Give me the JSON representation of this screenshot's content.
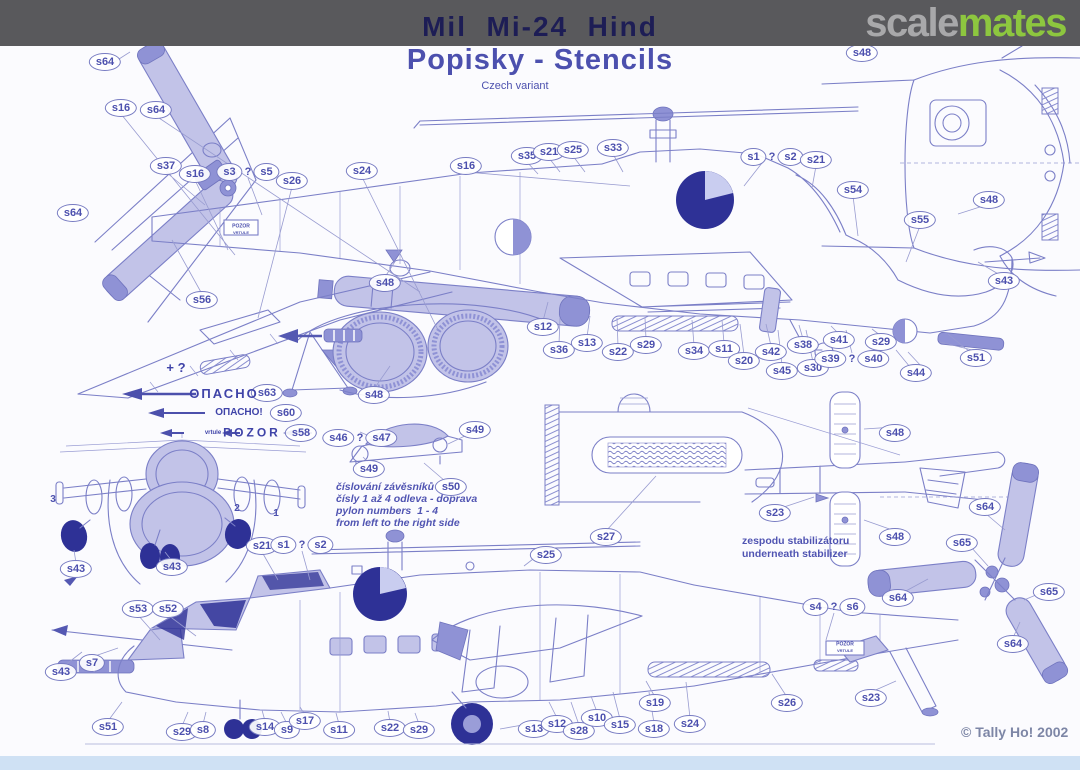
{
  "header": {
    "title": "Mil  Mi-24  Hind",
    "subtitle": "Popisky - Stencils",
    "variant": "Czech variant",
    "logo": {
      "part_gray": "scale",
      "part_green": "mates"
    }
  },
  "footer": {
    "copyright": "© Tally Ho! 2002"
  },
  "colors": {
    "bar": "#59595c",
    "title": "#1d1d55",
    "subtitle": "#4c50ae",
    "logo_gray": "#a8a8aa",
    "logo_green": "#8dc63f",
    "drawing_line": "#7b7fc7",
    "drawing_fill_light": "#c2c3e8",
    "drawing_fill_dark": "#2e3196",
    "footer_band": "#cfe1f4"
  },
  "callouts": [
    {
      "t": "s64",
      "x": 105,
      "y": 62
    },
    {
      "t": "s16",
      "x": 121,
      "y": 108
    },
    {
      "t": "s64",
      "x": 156,
      "y": 110
    },
    {
      "t": "s37",
      "x": 166,
      "y": 166
    },
    {
      "t": "s16",
      "x": 195,
      "y": 174
    },
    {
      "t": "s3 ? s5",
      "x": 248,
      "y": 172
    },
    {
      "t": "s64",
      "x": 73,
      "y": 213
    },
    {
      "t": "s26",
      "x": 292,
      "y": 181
    },
    {
      "t": "s24",
      "x": 362,
      "y": 171
    },
    {
      "t": "s16",
      "x": 466,
      "y": 166
    },
    {
      "t": "s48",
      "x": 385,
      "y": 283
    },
    {
      "t": "s35",
      "x": 527,
      "y": 156
    },
    {
      "t": "s21",
      "x": 549,
      "y": 152
    },
    {
      "t": "s25",
      "x": 573,
      "y": 150
    },
    {
      "t": "s33",
      "x": 613,
      "y": 148
    },
    {
      "t": "s1 ? s2",
      "x": 772,
      "y": 157
    },
    {
      "t": "s21",
      "x": 816,
      "y": 160
    },
    {
      "t": "s48",
      "x": 862,
      "y": 53
    },
    {
      "t": "s54",
      "x": 853,
      "y": 190
    },
    {
      "t": "s55",
      "x": 920,
      "y": 220
    },
    {
      "t": "s48",
      "x": 989,
      "y": 200
    },
    {
      "t": "s43",
      "x": 1004,
      "y": 281
    },
    {
      "t": "s51",
      "x": 976,
      "y": 358
    },
    {
      "t": "s44",
      "x": 916,
      "y": 373
    },
    {
      "t": "s12",
      "x": 543,
      "y": 327
    },
    {
      "t": "s36",
      "x": 559,
      "y": 350
    },
    {
      "t": "s13",
      "x": 587,
      "y": 343
    },
    {
      "t": "s22",
      "x": 618,
      "y": 352
    },
    {
      "t": "s29",
      "x": 646,
      "y": 345
    },
    {
      "t": "s34",
      "x": 694,
      "y": 351
    },
    {
      "t": "s11",
      "x": 724,
      "y": 349
    },
    {
      "t": "s20",
      "x": 744,
      "y": 361
    },
    {
      "t": "s42",
      "x": 771,
      "y": 352
    },
    {
      "t": "s45",
      "x": 782,
      "y": 371
    },
    {
      "t": "s38",
      "x": 803,
      "y": 345
    },
    {
      "t": "s30",
      "x": 813,
      "y": 368
    },
    {
      "t": "s41",
      "x": 839,
      "y": 340
    },
    {
      "t": "s39 ? s40",
      "x": 852,
      "y": 359
    },
    {
      "t": "s29",
      "x": 881,
      "y": 342
    },
    {
      "t": "s56",
      "x": 202,
      "y": 300
    },
    {
      "t": "s63",
      "x": 267,
      "y": 393
    },
    {
      "t": "s60",
      "x": 286,
      "y": 413
    },
    {
      "t": "s58",
      "x": 301,
      "y": 433
    },
    {
      "t": "s48",
      "x": 374,
      "y": 395
    },
    {
      "t": "s46 ? s47",
      "x": 360,
      "y": 438
    },
    {
      "t": "s49",
      "x": 475,
      "y": 430
    },
    {
      "t": "s49",
      "x": 369,
      "y": 469
    },
    {
      "t": "s50",
      "x": 451,
      "y": 487
    },
    {
      "t": "s27",
      "x": 606,
      "y": 537
    },
    {
      "t": "s25",
      "x": 546,
      "y": 555
    },
    {
      "t": "s48",
      "x": 895,
      "y": 433
    },
    {
      "t": "s23",
      "x": 775,
      "y": 513
    },
    {
      "t": "s48",
      "x": 895,
      "y": 537
    },
    {
      "t": "s64",
      "x": 985,
      "y": 507
    },
    {
      "t": "s65",
      "x": 962,
      "y": 543
    },
    {
      "t": "s64",
      "x": 898,
      "y": 598
    },
    {
      "t": "s65",
      "x": 1049,
      "y": 592
    },
    {
      "t": "s64",
      "x": 1013,
      "y": 644
    },
    {
      "t": "s43",
      "x": 76,
      "y": 569
    },
    {
      "t": "s43",
      "x": 172,
      "y": 567
    },
    {
      "t": "s21",
      "x": 262,
      "y": 546
    },
    {
      "t": "s1 ? s2",
      "x": 302,
      "y": 545
    },
    {
      "t": "s53",
      "x": 138,
      "y": 609
    },
    {
      "t": "s52",
      "x": 168,
      "y": 609
    },
    {
      "t": "s7",
      "x": 92,
      "y": 663
    },
    {
      "t": "s43",
      "x": 61,
      "y": 672
    },
    {
      "t": "s4 ? s6",
      "x": 834,
      "y": 607
    },
    {
      "t": "s51",
      "x": 108,
      "y": 727
    },
    {
      "t": "s29",
      "x": 182,
      "y": 732
    },
    {
      "t": "s8",
      "x": 203,
      "y": 730
    },
    {
      "t": "s14",
      "x": 265,
      "y": 727
    },
    {
      "t": "s9",
      "x": 287,
      "y": 730
    },
    {
      "t": "s17",
      "x": 305,
      "y": 721
    },
    {
      "t": "s11",
      "x": 339,
      "y": 730
    },
    {
      "t": "s22",
      "x": 390,
      "y": 728
    },
    {
      "t": "s29",
      "x": 419,
      "y": 730
    },
    {
      "t": "s13",
      "x": 534,
      "y": 729
    },
    {
      "t": "s12",
      "x": 557,
      "y": 724
    },
    {
      "t": "s28",
      "x": 579,
      "y": 731
    },
    {
      "t": "s10",
      "x": 597,
      "y": 718
    },
    {
      "t": "s15",
      "x": 620,
      "y": 725
    },
    {
      "t": "s19",
      "x": 655,
      "y": 703
    },
    {
      "t": "s18",
      "x": 654,
      "y": 729
    },
    {
      "t": "s24",
      "x": 690,
      "y": 724
    },
    {
      "t": "s26",
      "x": 787,
      "y": 703
    },
    {
      "t": "s23",
      "x": 871,
      "y": 698
    }
  ],
  "texts": [
    {
      "t": "+ ?",
      "x": 176,
      "y": 368,
      "size": 13,
      "cls": "stencil",
      "c": 1,
      "name": "plus-question-mark"
    },
    {
      "t": "ОПАСНО",
      "x": 224,
      "y": 394,
      "size": 13,
      "cls": "stencil spaced2",
      "c": 1,
      "name": "stencil-opasno"
    },
    {
      "t": "ОПАСНО!",
      "x": 239,
      "y": 413,
      "size": 10,
      "cls": "stencil",
      "c": 1,
      "name": "stencil-opasno-exclaim"
    },
    {
      "t": "vrtule",
      "x": 213,
      "y": 433,
      "size": 6,
      "cls": "stencil",
      "c": 1,
      "name": "stencil-vrtule-small"
    },
    {
      "t": "POZOR",
      "x": 252,
      "y": 433,
      "size": 12,
      "cls": "stencil spaced",
      "c": 1,
      "name": "stencil-pozor"
    },
    {
      "t": "3",
      "x": 53,
      "y": 500,
      "size": 10,
      "cls": "blue",
      "c": 1,
      "name": "pylon-number-3"
    },
    {
      "t": "2",
      "x": 237,
      "y": 509,
      "size": 10,
      "cls": "blue",
      "c": 1,
      "name": "pylon-number-2"
    },
    {
      "t": "1",
      "x": 276,
      "y": 514,
      "size": 10,
      "cls": "blue",
      "c": 1,
      "name": "pylon-number-1"
    },
    {
      "t": "POZOR",
      "x": 241,
      "y": 227,
      "size": 5,
      "cls": "blue",
      "c": 1,
      "name": "pozor-box-text"
    },
    {
      "t": "VRTULE",
      "x": 241,
      "y": 233,
      "size": 4,
      "cls": "blue",
      "c": 1,
      "name": "pozor-box-text"
    },
    {
      "t": "POZOR",
      "x": 845,
      "y": 645,
      "size": 5,
      "cls": "blue",
      "c": 1,
      "name": "pozor-box-text"
    },
    {
      "t": "VRTULE",
      "x": 845,
      "y": 651,
      "size": 4,
      "cls": "blue",
      "c": 1,
      "name": "pozor-box-text"
    },
    {
      "t": "číslování závěsníků",
      "x": 336,
      "y": 482,
      "size": 10.5,
      "cls": "noteit",
      "name": "pylon-note-line-1"
    },
    {
      "t": "čísly 1 až 4 odleva - doprava",
      "x": 336,
      "y": 494,
      "size": 10.5,
      "cls": "noteit",
      "name": "pylon-note-line-2"
    },
    {
      "t": "pylon numbers  1 - 4",
      "x": 336,
      "y": 506,
      "size": 10.5,
      "cls": "noteit",
      "name": "pylon-note-line-3"
    },
    {
      "t": "from left to the right side",
      "x": 336,
      "y": 518,
      "size": 10.5,
      "cls": "noteit",
      "name": "pylon-note-line-4"
    },
    {
      "t": "zespodu stabilizátoru",
      "x": 742,
      "y": 536,
      "size": 10.5,
      "cls": "note",
      "name": "stabilizer-note-line-1"
    },
    {
      "t": "underneath stabilizer",
      "x": 742,
      "y": 549,
      "size": 10.5,
      "cls": "note",
      "name": "stabilizer-note-line-2"
    }
  ]
}
